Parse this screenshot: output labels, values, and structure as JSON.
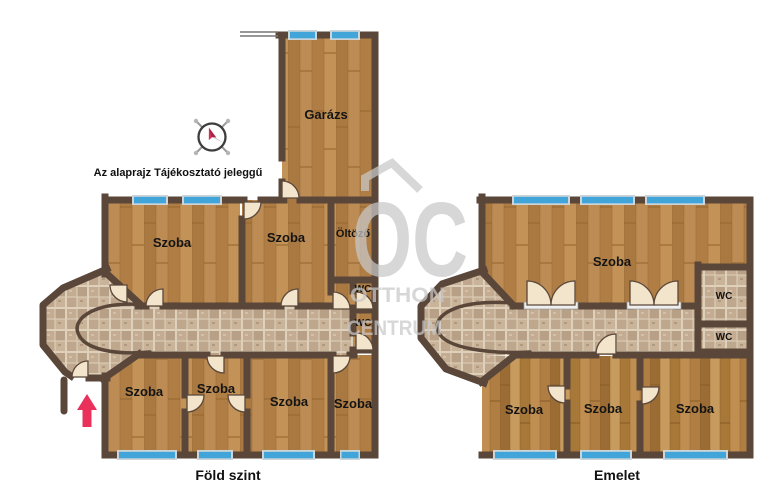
{
  "disclaimer": "Az alaprajz Tájékosztató jeleggű",
  "watermark": {
    "initials": "OC",
    "line1": "OTTHON",
    "line2": "CENTRUM"
  },
  "icons": {
    "compass": "compass-rose",
    "entrance_arrow": "entrance-arrow"
  },
  "ground_floor": {
    "title": "Föld szint",
    "labels": {
      "garage": "Garázs",
      "room_top_left": "Szoba",
      "room_top_mid": "Szoba",
      "dressing_room": "Öltöző",
      "wc_upper": "WC",
      "wc_lower": "WC",
      "room_bottom_1": "Szoba",
      "room_bottom_2": "Szoba",
      "room_bottom_3": "Szoba",
      "room_bottom_4": "Szoba"
    }
  },
  "upper_floor": {
    "title": "Emelet",
    "labels": {
      "room_large": "Szoba",
      "wc_upper": "WC",
      "wc_lower": "WC",
      "room_bottom_1": "Szoba",
      "room_bottom_2": "Szoba",
      "room_bottom_3": "Szoba"
    }
  },
  "colors": {
    "wall": "#5a473a",
    "wood": "#b5834b",
    "tile": "#c4ae95",
    "window": "#42a5da",
    "door": "#f3e5cb",
    "arrow": "#e9315b",
    "watermark": "#c9c9c9"
  }
}
